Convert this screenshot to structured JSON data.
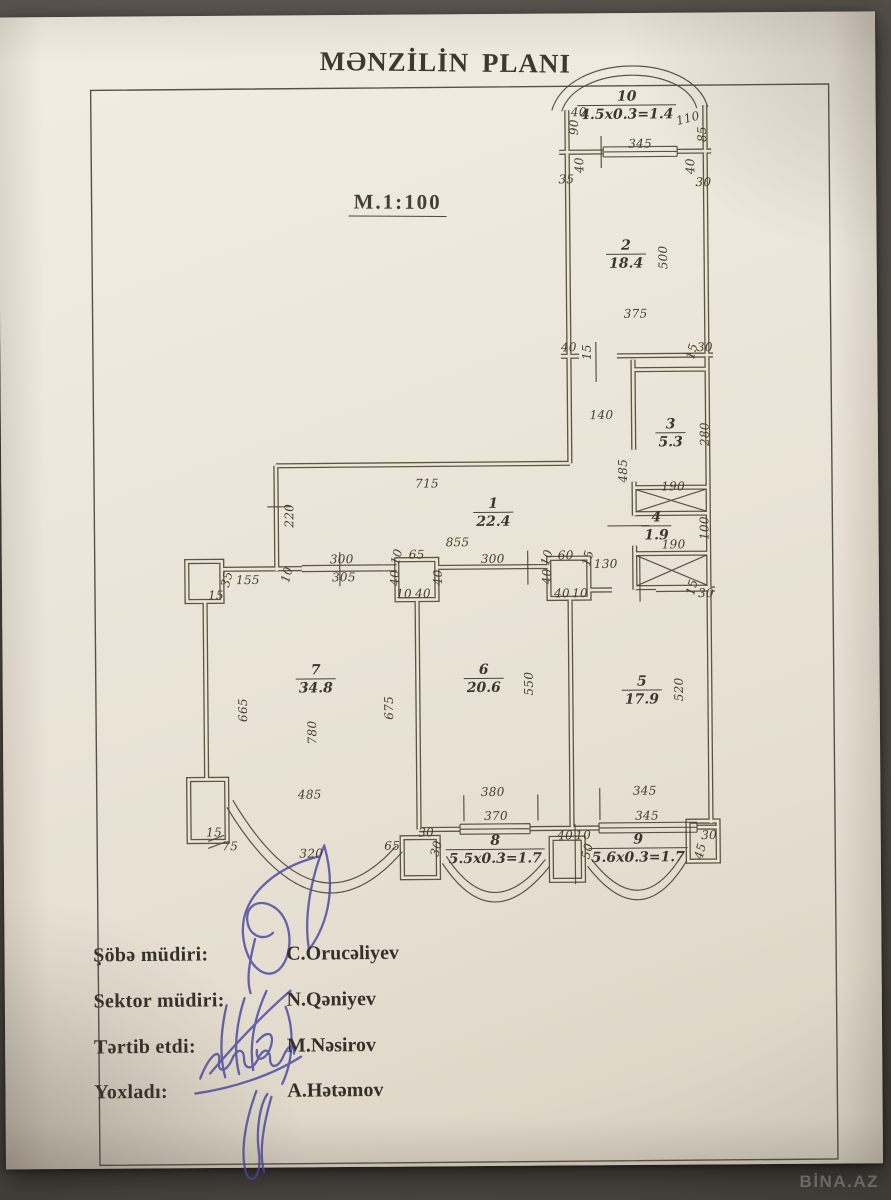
{
  "doc": {
    "title": "MƏNZİLİN PLANI",
    "scale": "M.1:100"
  },
  "photo": {
    "watermark": "BİNA.AZ"
  },
  "plan": {
    "rooms": [
      {
        "n": "10",
        "a": "4.5x0.3=1.4",
        "x": 631,
        "y": 108
      },
      {
        "n": "2",
        "a": "18.4",
        "x": 629,
        "y": 257
      },
      {
        "n": "3",
        "a": "5.3",
        "x": 672,
        "y": 436
      },
      {
        "n": "4",
        "a": "1.9",
        "x": 657,
        "y": 529
      },
      {
        "n": "1",
        "a": "22.4",
        "x": 494,
        "y": 514
      },
      {
        "n": "7",
        "a": "34.8",
        "x": 315,
        "y": 679
      },
      {
        "n": "6",
        "a": "20.6",
        "x": 483,
        "y": 680
      },
      {
        "n": "5",
        "a": "17.9",
        "x": 641,
        "y": 693
      },
      {
        "n": "8",
        "a": "5.5x0.3=1.7",
        "x": 493,
        "y": 851
      },
      {
        "n": "9",
        "a": "5.6x0.3=1.7",
        "x": 636,
        "y": 851
      }
    ],
    "dims": [
      {
        "t": "40",
        "x": 583,
        "y": 114,
        "r": 0
      },
      {
        "t": "90",
        "x": 578,
        "y": 129,
        "r": -90
      },
      {
        "t": "110",
        "x": 692,
        "y": 121,
        "r": -14
      },
      {
        "t": "85",
        "x": 706,
        "y": 137,
        "r": -90
      },
      {
        "t": "345",
        "x": 644,
        "y": 146,
        "r": 0
      },
      {
        "t": "40",
        "x": 583,
        "y": 167,
        "r": -90
      },
      {
        "t": "35",
        "x": 570,
        "y": 181,
        "r": 0
      },
      {
        "t": "40",
        "x": 694,
        "y": 169,
        "r": -90
      },
      {
        "t": "30",
        "x": 707,
        "y": 185,
        "r": 0
      },
      {
        "t": "500",
        "x": 666,
        "y": 260,
        "r": -90
      },
      {
        "t": "375",
        "x": 638,
        "y": 316,
        "r": 0
      },
      {
        "t": "40",
        "x": 571,
        "y": 349,
        "r": 0
      },
      {
        "t": "15",
        "x": 589,
        "y": 354,
        "r": -90
      },
      {
        "t": "15",
        "x": 694,
        "y": 354,
        "r": -75
      },
      {
        "t": "30",
        "x": 707,
        "y": 350,
        "r": 0
      },
      {
        "t": "140",
        "x": 603,
        "y": 417,
        "r": 0
      },
      {
        "t": "280",
        "x": 706,
        "y": 437,
        "r": -90
      },
      {
        "t": "485",
        "x": 624,
        "y": 473,
        "r": -90
      },
      {
        "t": "190",
        "x": 674,
        "y": 489,
        "r": 0
      },
      {
        "t": "100",
        "x": 705,
        "y": 531,
        "r": -90
      },
      {
        "t": "190",
        "x": 674,
        "y": 547,
        "r": 0
      },
      {
        "t": "130",
        "x": 606,
        "y": 566,
        "r": 0
      },
      {
        "t": "15",
        "x": 692,
        "y": 590,
        "r": -75
      },
      {
        "t": "30",
        "x": 706,
        "y": 596,
        "r": 0
      },
      {
        "t": "715",
        "x": 428,
        "y": 484,
        "r": 0
      },
      {
        "t": "855",
        "x": 458,
        "y": 543,
        "r": 0
      },
      {
        "t": "220",
        "x": 290,
        "y": 515,
        "r": -90
      },
      {
        "t": "35",
        "x": 227,
        "y": 578,
        "r": -75
      },
      {
        "t": "155",
        "x": 248,
        "y": 579,
        "r": 0
      },
      {
        "t": "15",
        "x": 216,
        "y": 594,
        "r": 0
      },
      {
        "t": "10",
        "x": 287,
        "y": 574,
        "r": -75
      },
      {
        "t": "300",
        "x": 342,
        "y": 559,
        "r": 0
      },
      {
        "t": "305",
        "x": 344,
        "y": 577,
        "r": 0
      },
      {
        "t": "10",
        "x": 397,
        "y": 557,
        "r": -75
      },
      {
        "t": "65",
        "x": 417,
        "y": 555,
        "r": 0
      },
      {
        "t": "40",
        "x": 395,
        "y": 578,
        "r": -90
      },
      {
        "t": "40",
        "x": 438,
        "y": 578,
        "r": -90
      },
      {
        "t": "10",
        "x": 404,
        "y": 594,
        "r": 0
      },
      {
        "t": "40",
        "x": 423,
        "y": 594,
        "r": 0
      },
      {
        "t": "300",
        "x": 493,
        "y": 560,
        "r": 0
      },
      {
        "t": "10",
        "x": 547,
        "y": 559,
        "r": -75
      },
      {
        "t": "60",
        "x": 566,
        "y": 557,
        "r": 0
      },
      {
        "t": "15",
        "x": 588,
        "y": 560,
        "r": -75
      },
      {
        "t": "40",
        "x": 547,
        "y": 578,
        "r": -90
      },
      {
        "t": "40",
        "x": 562,
        "y": 595,
        "r": 0
      },
      {
        "t": "10",
        "x": 580,
        "y": 595,
        "r": 0
      },
      {
        "t": "665",
        "x": 242,
        "y": 709,
        "r": -90
      },
      {
        "t": "675",
        "x": 388,
        "y": 708,
        "r": -90
      },
      {
        "t": "780",
        "x": 311,
        "y": 732,
        "r": -90
      },
      {
        "t": "485",
        "x": 308,
        "y": 794,
        "r": 0
      },
      {
        "t": "15",
        "x": 212,
        "y": 831,
        "r": 0
      },
      {
        "t": "75",
        "x": 228,
        "y": 845,
        "r": 0
      },
      {
        "t": "320",
        "x": 309,
        "y": 853,
        "r": 0
      },
      {
        "t": "65",
        "x": 390,
        "y": 846,
        "r": 0
      },
      {
        "t": "550",
        "x": 528,
        "y": 685,
        "r": -90
      },
      {
        "t": "380",
        "x": 491,
        "y": 793,
        "r": 0
      },
      {
        "t": "370",
        "x": 494,
        "y": 817,
        "r": 0
      },
      {
        "t": "30",
        "x": 424,
        "y": 833,
        "r": 0
      },
      {
        "t": "30",
        "x": 434,
        "y": 849,
        "r": -75
      },
      {
        "t": "520",
        "x": 678,
        "y": 692,
        "r": -90
      },
      {
        "t": "345",
        "x": 643,
        "y": 793,
        "r": 0
      },
      {
        "t": "345",
        "x": 645,
        "y": 818,
        "r": 0
      },
      {
        "t": "40",
        "x": 563,
        "y": 837,
        "r": 0
      },
      {
        "t": "10",
        "x": 581,
        "y": 837,
        "r": 0
      },
      {
        "t": "50",
        "x": 585,
        "y": 853,
        "r": -75
      },
      {
        "t": "30",
        "x": 707,
        "y": 838,
        "r": 0
      },
      {
        "t": "45",
        "x": 698,
        "y": 854,
        "r": -75
      }
    ]
  },
  "signatures": {
    "rows": [
      {
        "role": "Şöbə müdiri:",
        "name": "C.Orucəliyev"
      },
      {
        "role": "Sektor müdiri:",
        "name": "N.Qəniyev"
      },
      {
        "role": "Tərtib etdi:",
        "name": "M.Nəsirov"
      },
      {
        "role": "Yoxladı:",
        "name": "A.Hətəmov"
      }
    ]
  }
}
